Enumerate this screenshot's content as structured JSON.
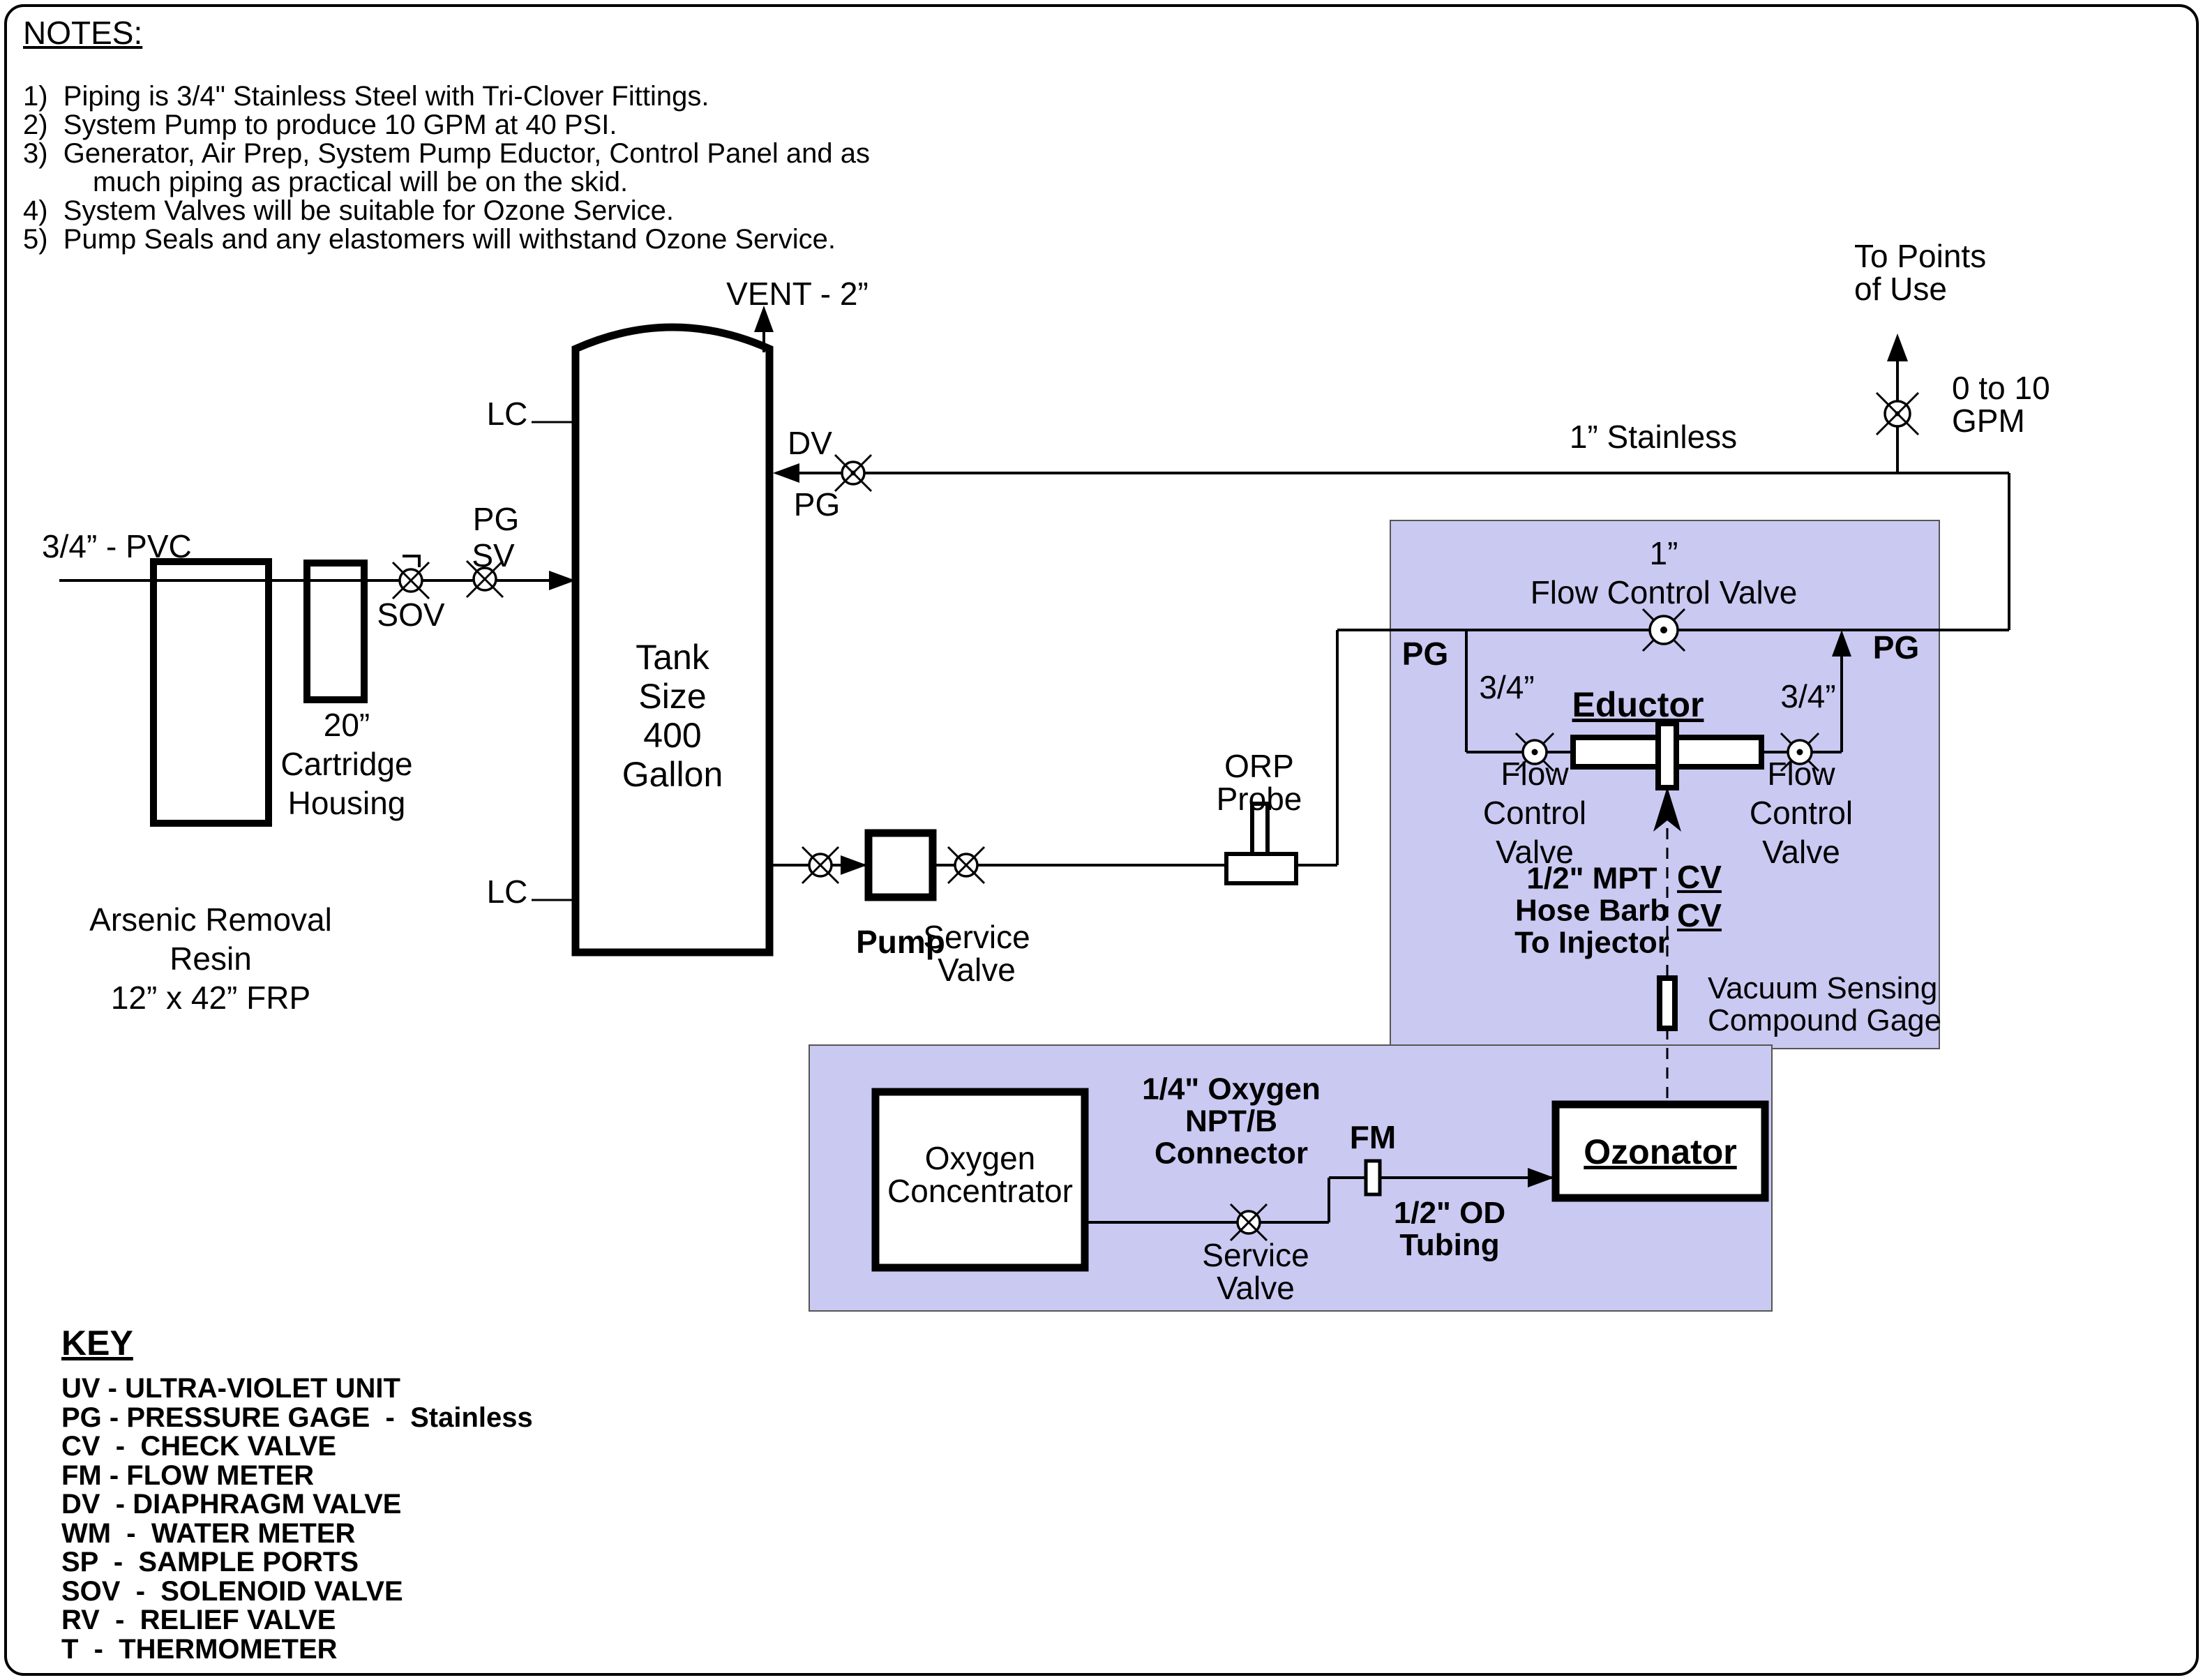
{
  "colors": {
    "skid_fill": "#c9c9f2",
    "skid_border": "#555555",
    "line": "#000000",
    "background": "#ffffff"
  },
  "notes": {
    "title": "NOTES:",
    "lines": [
      "1)  Piping is 3/4\" Stainless Steel with Tri-Clover Fittings.",
      "2)  System Pump to produce 10 GPM at 40 PSI.",
      "3)  Generator, Air Prep, System Pump Eductor, Control Panel and as",
      "much piping as practical will be on the skid.",
      "4)  System Valves will be suitable for Ozone Service.",
      "5)  Pump Seals and any elastomers will withstand Ozone Service."
    ]
  },
  "key": {
    "title": "KEY",
    "items": [
      "UV - ULTRA-VIOLET UNIT",
      "PG - PRESSURE GAGE  -  Stainless",
      "CV  -  CHECK VALVE",
      "FM - FLOW METER",
      "DV  - DIAPHRAGM VALVE",
      "WM  -  WATER METER",
      "SP  -  SAMPLE PORTS",
      "SOV  -  SOLENOID VALVE",
      "RV  -  RELIEF VALVE",
      "T  -  THERMOMETER"
    ]
  },
  "labels": {
    "vent": "VENT - 2”",
    "lc_top": "LC",
    "lc_bottom": "LC",
    "pvc": "3/4” - PVC",
    "pg_inlet": "PG",
    "sv_inlet": "SV",
    "sov": "SOV",
    "cartridge": "20”\nCartridge\nHousing",
    "resin": "Arsenic Removal\nResin\n12” x 42” FRP",
    "tank": "Tank\nSize\n400\nGallon",
    "dv": "DV",
    "pg_tank": "PG",
    "stainless": "1” Stainless",
    "to_points": "To Points\nof Use",
    "gpm": "0 to 10\nGPM",
    "fcv_main": "1”\nFlow Control Valve",
    "pg_skid_left": "PG",
    "pg_skid_right": "PG",
    "size_left": "3/4”",
    "size_right": "3/4”",
    "eductor": "Eductor",
    "fcv_left": "Flow\nControl\nValve",
    "fcv_right": "Flow\nControl\nValve",
    "mpt": "1/2\" MPT\nHose Barb\nTo Injector",
    "cv_top": "CV",
    "cv_bottom": "CV",
    "vacuum": "Vacuum Sensing\nCompound Gage",
    "ozonator": "Ozonator",
    "orp": "ORP\nProbe",
    "pump": "Pump",
    "service_valve": "Service\nValve",
    "oxygen": "Oxygen\nConcentrator",
    "connector": "1/4\" Oxygen\nNPT/B\nConnector",
    "fm": "FM",
    "service_valve_o2": "Service\nValve",
    "tubing": "1/2\" OD\nTubing"
  }
}
